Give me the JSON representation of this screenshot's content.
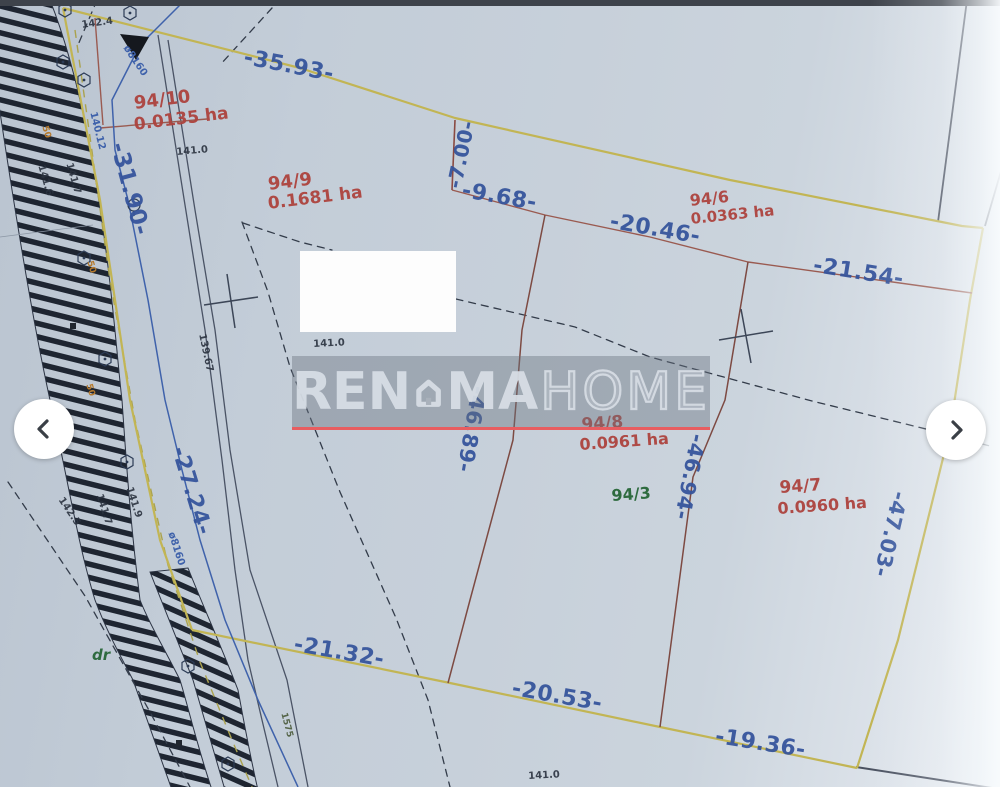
{
  "view": {
    "type": "listing-photo-viewer",
    "content": "cadastral survey map scan"
  },
  "colors": {
    "dimension_blue": "#35549c",
    "parcel_red": "#ad433e",
    "boundary_yellow": "#c2b554",
    "boundary_brown": "#8a4a42",
    "note_green": "#2e6b3f",
    "utility_blue": "#3f62ab",
    "watermark_red_line": "#e85d60",
    "paper": "#c3cdd8",
    "topbar": "#3e434b"
  },
  "icons": {
    "prev": "chevron-left",
    "next": "chevron-right",
    "watermark_logo": "house"
  },
  "watermark": {
    "part1": "REN",
    "part2": "MA",
    "part3": "HOME"
  },
  "parcels": {
    "p94_10": {
      "number": "94/10",
      "area": "0.0135 ha"
    },
    "p94_9": {
      "number": "94/9",
      "area": "0.1681 ha"
    },
    "p94_6": {
      "number": "94/6",
      "area": "0.0363 ha"
    },
    "p94_8": {
      "number": "94/8",
      "area": "0.0961 ha"
    },
    "p94_7": {
      "number": "94/7",
      "area": "0.0960 ha"
    },
    "p94_3": {
      "number": "94/3"
    }
  },
  "dims": {
    "d35_93": "-35.93-",
    "d31_90": "-31.90-",
    "d7_00": "-7.00-",
    "d9_68": "-9.68-",
    "d20_46": "-20.46-",
    "d21_54": "-21.54-",
    "d27_24": "-27.24-",
    "d46_89": "-46.89-",
    "d46_94": "-46.94-",
    "d47_03": "-47.03-",
    "d21_32": "-21.32-",
    "d20_53": "-20.53-",
    "d19_36": "-19.36-"
  },
  "elevations": {
    "e142_4": "142.4",
    "e141_0": "141.0",
    "e141_6": "141.6",
    "e141_7": "141.7",
    "e141_9": "141.9",
    "e142_5": "142.5",
    "e139_67": "139.67",
    "e140_12": "140.12",
    "e1575": "1575"
  },
  "utility": {
    "pipe": "ø8160"
  },
  "road": {
    "label": "dr"
  },
  "marks": {
    "m50": "50"
  }
}
